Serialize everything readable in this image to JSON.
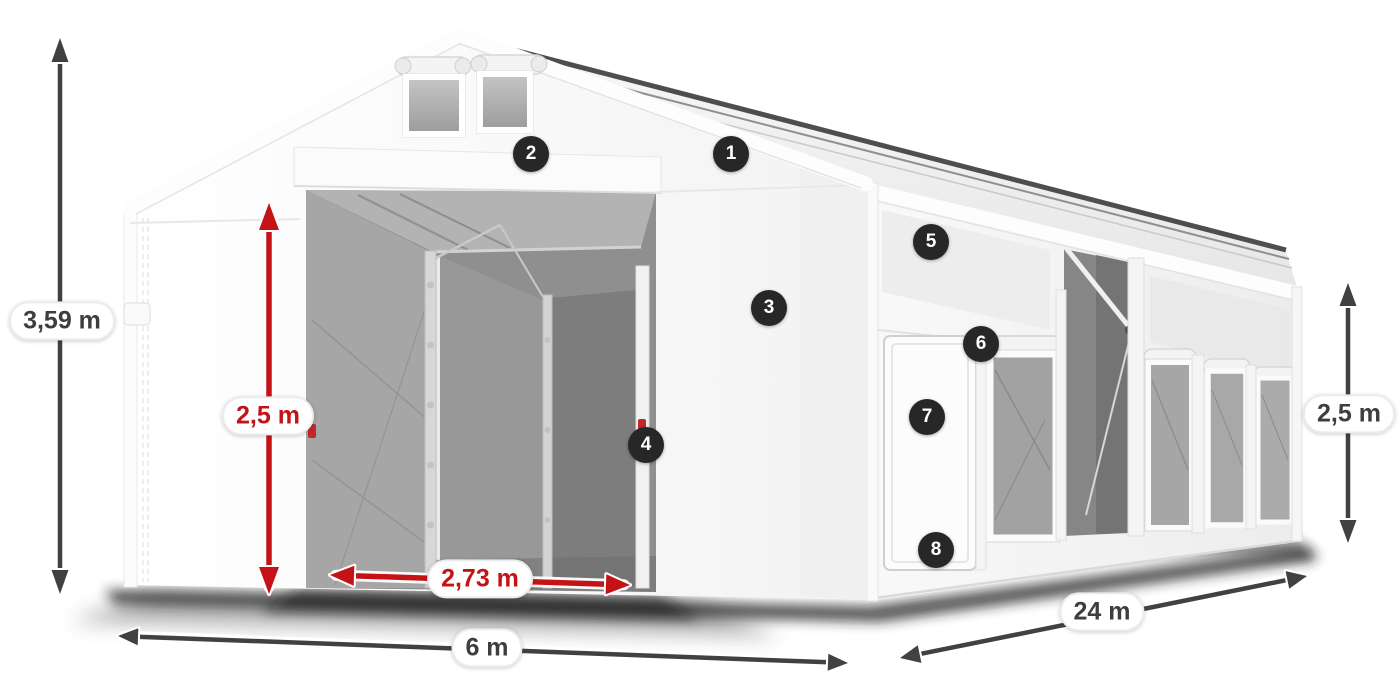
{
  "colors": {
    "dimension_arrow": "#414141",
    "accent_red": "#c41316",
    "badge_bg": "#272727",
    "badge_text": "#ffffff",
    "label_bg": "#ffffff",
    "label_border": "#ececec",
    "label_text_dark": "#3e3e3e"
  },
  "dimensions": {
    "total_height": {
      "value": "3,59 m"
    },
    "inner_door_height": {
      "value": "2,5 m"
    },
    "door_width": {
      "value": "2,73 m"
    },
    "front_width": {
      "value": "6 m"
    },
    "side_length": {
      "value": "24 m"
    },
    "side_wall_height": {
      "value": "2,5 m"
    }
  },
  "badges": {
    "items": [
      {
        "number": "1"
      },
      {
        "number": "2"
      },
      {
        "number": "3"
      },
      {
        "number": "4"
      },
      {
        "number": "5"
      },
      {
        "number": "6"
      },
      {
        "number": "7"
      },
      {
        "number": "8"
      }
    ]
  }
}
